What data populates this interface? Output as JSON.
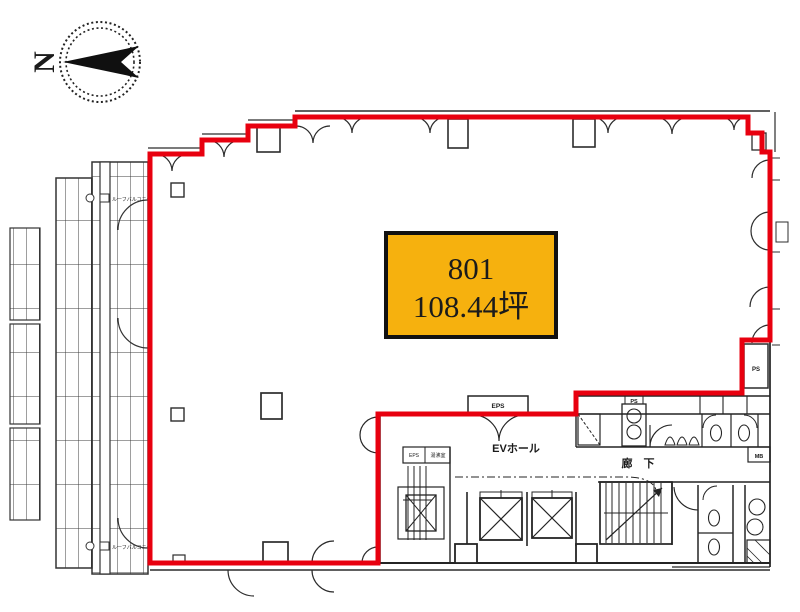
{
  "compass": {
    "letter": "N"
  },
  "unit_label": {
    "number": "801",
    "area": "108.44坪"
  },
  "labels": {
    "eps_top": "EPS",
    "ev_hall": "EVホール",
    "corridor": "廊　下",
    "ps_right": "PS",
    "ps_core": "PS",
    "mb": "MB",
    "eps_room": "EPS",
    "pantry": "湯沸室",
    "balcony_note_top": "ルーフバルコニー",
    "balcony_note_bottom": "ルーフバルコニー"
  },
  "colors": {
    "outline_red": "#e8000f",
    "label_yellow": "#f6b10e",
    "ink": "#1b1b1b"
  }
}
